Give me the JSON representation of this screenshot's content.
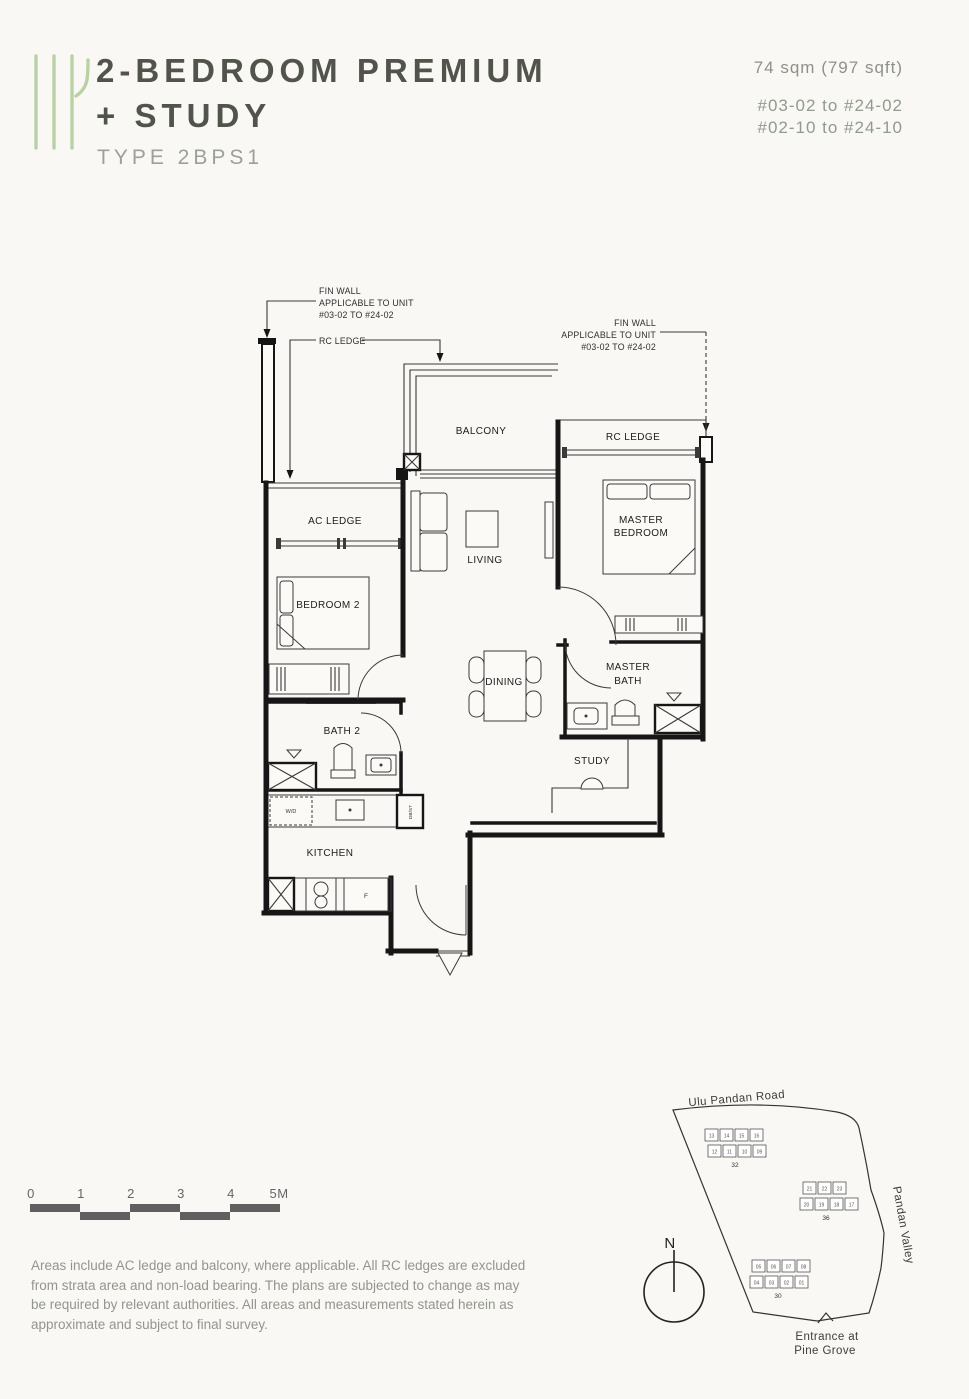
{
  "header": {
    "title_line1": "2-BEDROOM PREMIUM",
    "title_line2": "+ STUDY",
    "type_label": "TYPE 2BPS1",
    "area": "74 sqm (797 sqft)",
    "units_line1": "#03-02 to #24-02",
    "units_line2": "#02-10 to #24-10"
  },
  "floorplan": {
    "labels": {
      "fin_wall_1": "FIN WALL",
      "fin_wall_2": "APPLICABLE TO UNIT",
      "fin_wall_3": "#03-02 TO #24-02",
      "rc_ledge": "RC LEDGE"
    },
    "rooms": {
      "balcony": "BALCONY",
      "ac_ledge": "AC LEDGE",
      "living": "LIVING",
      "master_bedroom_1": "MASTER",
      "master_bedroom_2": "BEDROOM",
      "bedroom2": "BEDROOM 2",
      "dining": "DINING",
      "master_bath_1": "MASTER",
      "master_bath_2": "BATH",
      "bath2": "BATH 2",
      "study": "STUDY",
      "kitchen": "KITCHEN"
    },
    "fixtures": {
      "washer": "W/D",
      "fridge": "F",
      "db": "DB/ST"
    }
  },
  "scalebar": {
    "ticks": [
      "0",
      "1",
      "2",
      "3",
      "4",
      "5M"
    ]
  },
  "disclaimer": {
    "line1": "Areas include AC ledge and balcony, where applicable. All RC ledges are excluded from",
    "line2": "strata area and non-load bearing. The plans are subjected to change as may be required",
    "line3": "by relevant authorities. All areas and measurements stated herein as approximate and",
    "line4": "subject to final survey."
  },
  "sitemap": {
    "road_top": "Ulu Pandan Road",
    "road_right": "Pandan Valley",
    "entrance_1": "Entrance at",
    "entrance_2": "Pine Grove",
    "north": "N",
    "highlight_color": "#b7cfa2",
    "clusters": [
      {
        "label": "32",
        "top": [
          "13",
          "14",
          "15",
          "16"
        ],
        "bottom": [
          "12",
          "11",
          "10",
          "09"
        ]
      },
      {
        "label": "36",
        "top": [
          "21",
          "22",
          "23"
        ],
        "bottom": [
          "20",
          "19",
          "18",
          "17"
        ]
      },
      {
        "label": "30",
        "top": [
          "05",
          "06",
          "07",
          "08"
        ],
        "bottom": [
          "04",
          "03",
          "02",
          "01"
        ]
      }
    ]
  }
}
